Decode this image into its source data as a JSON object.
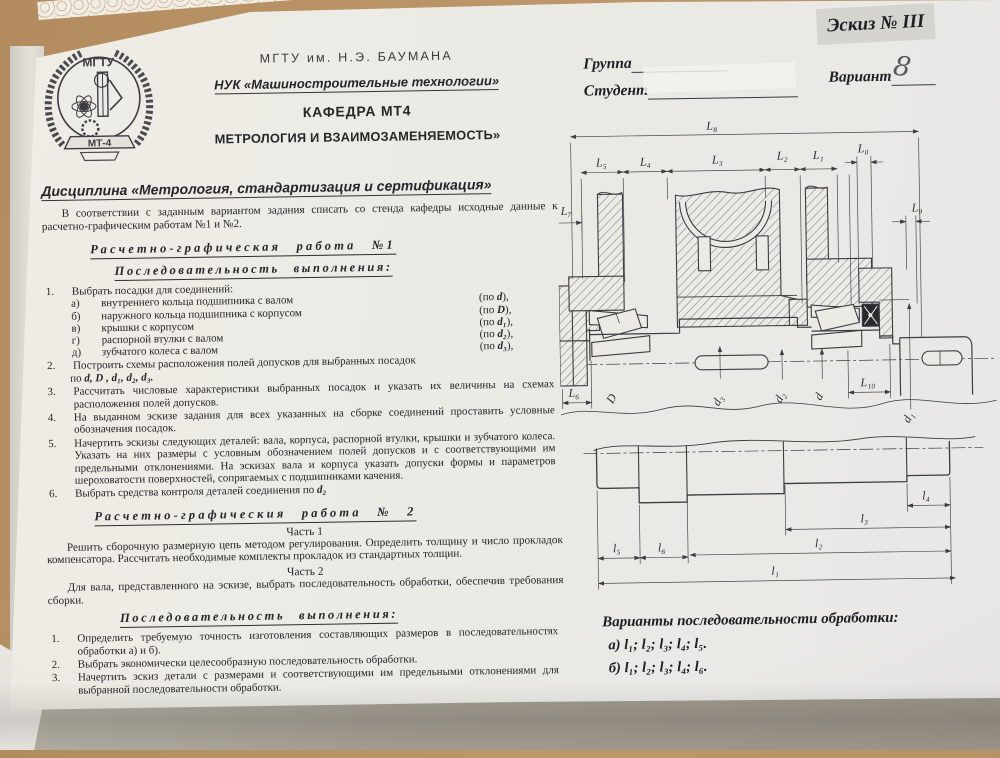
{
  "photo": {
    "sketch_label": "Эскиз № III",
    "group_label": "Группа",
    "student_label": "Студент",
    "variant_label": "Вариант",
    "variant_value": "8"
  },
  "header": {
    "university": "МГТУ им. Н.Э. БАУМАНА",
    "faculty": "НУК  «Машиностроительные технологии»",
    "department": "КАФЕДРА МТ4",
    "subtitle": "МЕТРОЛОГИЯ И ВЗАИМОЗАМЕНЯЕМОСТЬ»",
    "discipline": "Дисциплина «Метрология, стандартизация и сертификация»",
    "logo_top": "МГТУ",
    "logo_bottom": "МТ-4"
  },
  "intro": "В соответствии с заданным  вариантом задания списать со стенда кафедры исходные данные  к расчетно-графическим работам №1 и №2.",
  "work1": {
    "title": "Расчетно-графическая работа №1",
    "subtitle": "Последовательность выполнения:",
    "i1": {
      "num": "1.",
      "text": "Выбрать посадки для соединений:"
    },
    "subs": [
      {
        "label": "а)",
        "text": "внутреннего кольца подшипника с валом",
        "np": "(по ",
        "ns": "d",
        "nx": "),"
      },
      {
        "label": "б)",
        "text": "наружного кольца подшипника с корпусом",
        "np": "(по ",
        "ns": "D",
        "nx": "),"
      },
      {
        "label": "в)",
        "text": "крышки с корпусом",
        "np": "(по ",
        "ns": "d₁",
        "nx": "),"
      },
      {
        "label": "г)",
        "text": "распорной втулки с валом",
        "np": "(по ",
        "ns": "d₂",
        "nx": "),"
      },
      {
        "label": "д)",
        "text": "зубчатого колеса с валом",
        "np": "(по ",
        "ns": "d₃",
        "nx": "),"
      }
    ],
    "i2": {
      "num": "2.",
      "text": "Построить схемы расположения полей допусков для выбранных посадок",
      "fp": "по ",
      "fs": "d, D , d₁, d₂, d₃."
    },
    "i3": {
      "num": "3.",
      "text": "Рассчитать числовые характеристики выбранных посадок и указать их величины на схемах расположения полей допусков."
    },
    "i4": {
      "num": "4.",
      "text": "На выданном эскизе задания для всех указанных на сборке соединений проставить условные обозначения посадок."
    },
    "i5": {
      "num": "5.",
      "text": "Начертить эскизы  следующих деталей:  вала, корпуса, распорной втулки, крышки  и зубчатого  колеса. Указать на них размеры с условным обозначением полей допусков и с соответствующими им предельными отклонениями. На эскизах вала и корпуса указать допуски формы и параметров шероховатости поверхностей, сопрягаемых с подшипниками качения."
    },
    "i6": {
      "num": "6.",
      "text": "Выбрать средства контроля деталей соединения по ",
      "fs": "d₂"
    }
  },
  "work2": {
    "title": "Расчетно-графическия  работа  №  2",
    "part1_label": "Часть 1",
    "part1_text": "Решить сборочную размерную цепь методом регулирования. Определить толщину и число прокладок компенсатора. Рассчитать необходимые комплекты прокладок из стандартных толщин.",
    "part2_label": "Часть 2",
    "part2_text": "Для вала, представленного на эскизе, выбрать последовательность обработки, обеспечив требования сборки.",
    "seq_title": "Последовательность  выполнения:",
    "items": [
      {
        "num": "1.",
        "text": "Определить требуемую точность изготовления составляющих размеров в последовательностях обработки а) и б)."
      },
      {
        "num": "2.",
        "text": "Выбрать экономически целесообразную последовательность обработки."
      },
      {
        "num": "3.",
        "text": "Начертить эскиз детали с размерами и соответствующими им предельными отклонениями для выбранной последовательности обработки."
      }
    ]
  },
  "assembly": {
    "L8": "L₈",
    "L5": "L₅",
    "L4": "L₄",
    "L3": "L₃",
    "L2": "L₂",
    "L1": "L₁",
    "L0": "L₀",
    "L9": "L₉",
    "L7": "L₇",
    "L6": "L₆",
    "L10": "L₁₀",
    "D": "D",
    "d3": "d₃",
    "d2": "d₂",
    "d": "d",
    "d1": "d₁"
  },
  "shaft": {
    "l1": "l₁",
    "l2": "l₂",
    "l3": "l₃",
    "l4": "l₄",
    "l5": "l₅",
    "l6": "l₆"
  },
  "variants": {
    "title": "Варианты последовательности обработки:",
    "option_a": "а) l₁; l₂; l₃; l₄; l₅.",
    "option_b": "б) l₁; l₂; l₃; l₄; l₆."
  }
}
